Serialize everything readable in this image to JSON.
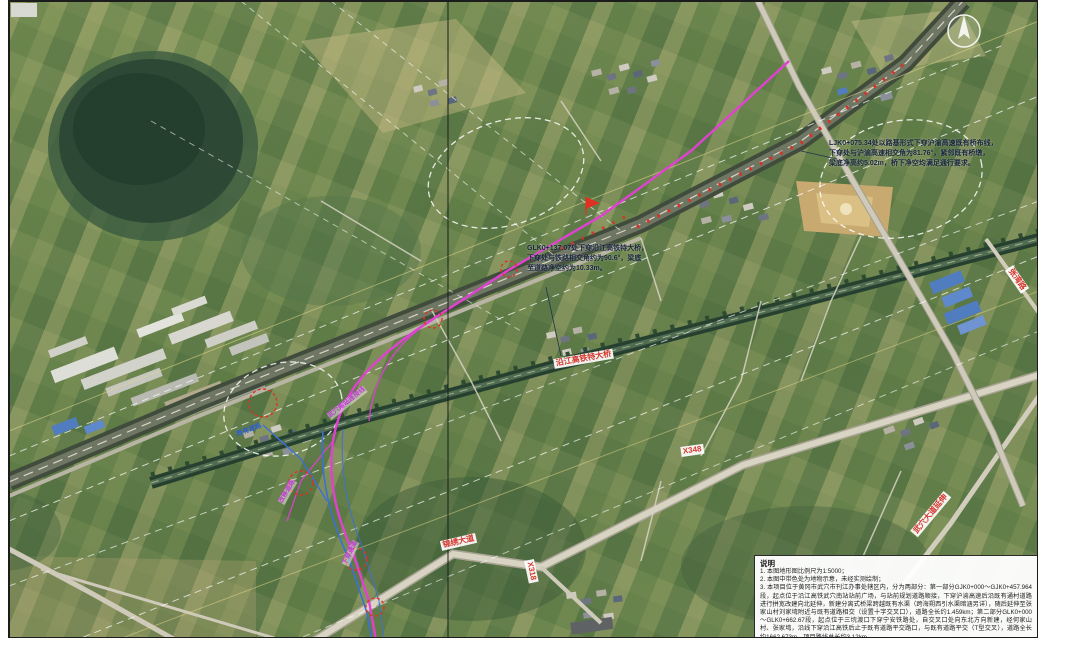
{
  "annotations": {
    "top_right": {
      "lines": [
        "LJK0+075.34处以路基形式下穿沪渝高速既有桥布线，",
        "下穿处与沪渝高速相交角为81.76°，紧邻既有桥墩，",
        "梁底净高约5.02m，桥下净空均满足通行要求。"
      ]
    },
    "center": {
      "lines": [
        "GLK0+137.07处下穿沿江高铁特大桥，",
        "下穿处与铁路相交角约为90.6°，梁底",
        "至道路净空约为10.33m。"
      ]
    }
  },
  "road_labels": [
    {
      "text": "沿江高铁特大桥"
    },
    {
      "text": "锦绣大道"
    },
    {
      "text": "X318"
    },
    {
      "text": "X348"
    },
    {
      "text": "张湾路"
    },
    {
      "text": "武穴大道延伸"
    }
  ],
  "route_labels": [
    {
      "text": "武穴南站连接线"
    },
    {
      "text": "改移道路"
    },
    {
      "text": "下穿通道"
    },
    {
      "text": "既有道路"
    }
  ],
  "notes": {
    "title": "说明",
    "items": [
      "1. 本图地形图比例尺为1:5000；",
      "2. 本图中带色处为地物示意，未经实测绘制；",
      "3. 本项目位于黄冈市武穴市刊江办事处辖区内，分为两部分：第一部分GJK0+000～GJK0+457.964段，起点位于沿江高铁武穴南站站前广场，与站前规划道路顺接，下穿沪渝高速后沿既有通村道路进行拼宽改建向北延伸，新建分离式桥梁跨越既有水渠（跨海朔西引水渠暗涵另详），随后延伸至张家山村刘家塆附近与既有道路相交（设置十字交叉口），道路全长约1.459km；第二部分GLK0+000～GLK0+662.67段，起点位于三垸渡口下穿宁安铁路处，自交叉口处向东北方向新建，经何家山村、张家塆，沿线下穿沿江高铁后止于既有道路平交路口，与既有道路平交（T型交叉），道路全长约1662.673m，项目路线总长约3.12km。"
    ]
  },
  "colors": {
    "route_magenta": "#e23fd3",
    "demolition_red": "#e03020",
    "ramp_blue": "#3a6fd8",
    "label_red": "#d4372c"
  }
}
